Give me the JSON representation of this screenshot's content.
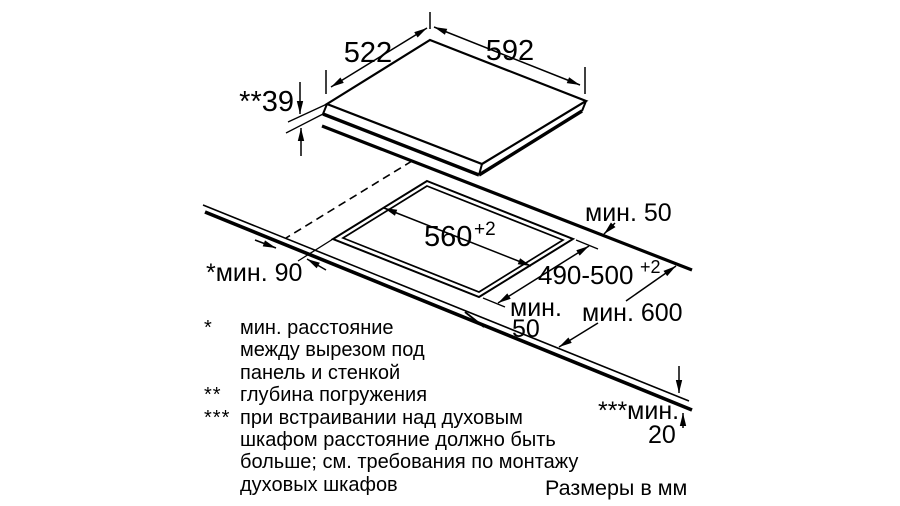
{
  "diagram": {
    "cooktop": {
      "width": "592",
      "depth": "522",
      "immersion_depth": "**39"
    },
    "cutout": {
      "width": "560",
      "width_tolerance": "+2",
      "depth": "490-500",
      "depth_tolerance": "+2"
    },
    "clearances": {
      "back_clearance": "мин. 50",
      "front_clearance_line1": "мин.",
      "front_clearance_line2": "50",
      "side_wall_clearance": "*мин. 90",
      "worktop_depth": "мин. 600",
      "worktop_thickness_label": "***мин.",
      "worktop_thickness_value": "20"
    }
  },
  "footnotes": [
    {
      "marker": "*",
      "lines": [
        "мин. расстояние",
        "между вырезом под",
        "панель и стенкой"
      ]
    },
    {
      "marker": "**",
      "lines": [
        "глубина погружения"
      ]
    },
    {
      "marker": "***",
      "lines": [
        "при встраивании над духовым",
        "шкафом расстояние должно быть",
        "больше; см. требования по монтажу",
        "духовых шкафов"
      ]
    }
  ],
  "units_note": "Размеры в мм",
  "colors": {
    "ink": "#000000",
    "background": "#ffffff"
  }
}
